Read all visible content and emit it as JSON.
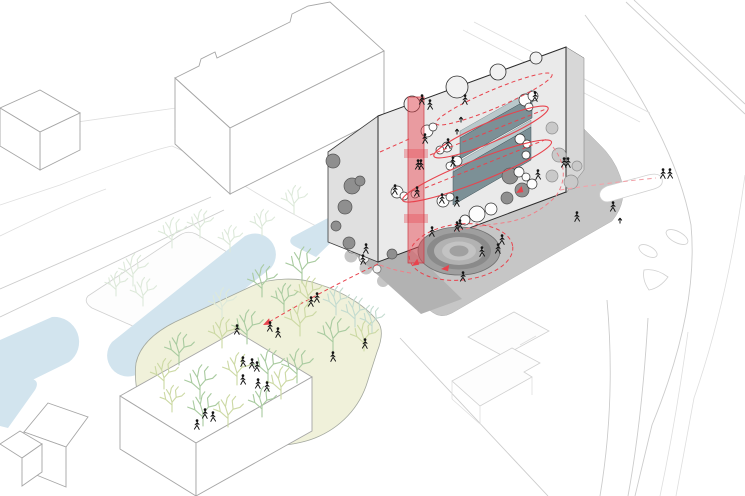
{
  "meta": {
    "type": "architectural-axonometric-circulation-diagram",
    "visible_text": "none"
  },
  "palette": {
    "water": "#d2e4ee",
    "parkFill": "#f0f1da",
    "parkStroke": "#a3a89e",
    "plaza": "#c6c6c6",
    "apron": "#b2b2b2",
    "roof": "#e2e2e2",
    "sideWall": "#d7d7d7",
    "westWall": "#e0e0e0",
    "face": "#eaeaea",
    "outline": "#2b2b2b",
    "slab": "#7c9096",
    "slabTop": "#b9c8cb",
    "slabEdge": "#3f5258",
    "red": "#e8434d",
    "redMid": "#ef8089",
    "redLight": "#f2a3aa",
    "shaftFill": "rgba(233,70,80,0.48)",
    "shaftBand": "rgba(233,70,80,0.36)",
    "shaftStroke": "#c93842",
    "figure": "#141414",
    "road": "#cccccc",
    "roadFaint": "#dedede",
    "contextStroke": "#a6a6a6",
    "faintStroke": "#d0d0d0",
    "cloudWhite": "#fdfdfd",
    "cloudWhiteStroke": "#2e2e2e",
    "cloudDark": "#8f8f8f",
    "cloudDarkStroke": "#565656",
    "cloudExt": "#c9c9c9",
    "cloudExtStroke": "#8f8f8f",
    "biteFill": "#f1f1f1",
    "treeGreen": "#a9cba0",
    "treeYellow": "#ccd9a4",
    "treeBlue": "#c3dbcf",
    "treeFaint": "#dde9da"
  },
  "amphitheater": {
    "cx": 459,
    "cy": 251,
    "rings": [
      {
        "rx": 41,
        "ry": 24,
        "fill": "#9f9f9f",
        "stroke": "#6f6f6f"
      },
      {
        "rx": 32,
        "ry": 18.5,
        "fill": "#8a8a8a",
        "stroke": "none"
      },
      {
        "rx": 25,
        "ry": 14,
        "fill": "#b2b2b2",
        "stroke": "none"
      },
      {
        "rx": 17,
        "ry": 9.5,
        "fill": "#c3c3c3",
        "stroke": "none"
      },
      {
        "rx": 9.5,
        "ry": 5.5,
        "fill": "#a0a0a0",
        "stroke": "none"
      }
    ]
  },
  "bites": [
    {
      "x": 412,
      "y": 104,
      "r": 8
    },
    {
      "x": 457,
      "y": 87,
      "r": 11
    },
    {
      "x": 498,
      "y": 72,
      "r": 8
    },
    {
      "x": 536,
      "y": 58,
      "r": 6
    }
  ],
  "clouds": {
    "white": [
      [
        427,
        131,
        6
      ],
      [
        433,
        127,
        4
      ],
      [
        447,
        147,
        5
      ],
      [
        440,
        150,
        4
      ],
      [
        457,
        161,
        5
      ],
      [
        450,
        166,
        4
      ],
      [
        397,
        192,
        6
      ],
      [
        404,
        196,
        4
      ],
      [
        415,
        194,
        4
      ],
      [
        443,
        201,
        6
      ],
      [
        450,
        197,
        4
      ],
      [
        525,
        100,
        6
      ],
      [
        533,
        96,
        5
      ],
      [
        529,
        107,
        4
      ],
      [
        520,
        139,
        5
      ],
      [
        527,
        144,
        4
      ],
      [
        526,
        155,
        4
      ],
      [
        519,
        172,
        5
      ],
      [
        526,
        177,
        4
      ],
      [
        532,
        184,
        5
      ],
      [
        477,
        214,
        8
      ],
      [
        491,
        209,
        6
      ],
      [
        465,
        220,
        5
      ]
    ],
    "dark": [
      [
        333,
        161,
        7
      ],
      [
        352,
        186,
        8
      ],
      [
        360,
        181,
        5
      ],
      [
        345,
        207,
        7
      ],
      [
        336,
        226,
        5
      ],
      [
        349,
        243,
        6
      ],
      [
        510,
        176,
        8
      ],
      [
        522,
        190,
        7
      ],
      [
        507,
        198,
        6
      ],
      [
        392,
        254,
        5
      ]
    ],
    "exterior": [
      [
        552,
        128,
        6
      ],
      [
        559,
        155,
        7
      ],
      [
        552,
        176,
        6
      ],
      [
        571,
        182,
        7
      ],
      [
        577,
        166,
        5
      ]
    ],
    "apron_bites": [
      [
        352,
        248,
        5
      ],
      [
        364,
        258,
        5
      ],
      [
        377,
        269,
        4
      ]
    ]
  },
  "trees": {
    "park": [
      {
        "x": 302,
        "y": 283,
        "c": "g",
        "s": 1.9
      },
      {
        "x": 262,
        "y": 297,
        "c": "g",
        "s": 1.7
      },
      {
        "x": 222,
        "y": 318,
        "c": "f",
        "s": 1.6
      },
      {
        "x": 247,
        "y": 344,
        "c": "g",
        "s": 1.8
      },
      {
        "x": 222,
        "y": 348,
        "c": "y",
        "s": 1.6
      },
      {
        "x": 179,
        "y": 365,
        "c": "g",
        "s": 1.7
      },
      {
        "x": 164,
        "y": 389,
        "c": "y",
        "s": 1.6
      },
      {
        "x": 200,
        "y": 399,
        "c": "g",
        "s": 1.8
      },
      {
        "x": 237,
        "y": 385,
        "c": "y",
        "s": 1.7
      },
      {
        "x": 268,
        "y": 383,
        "c": "g",
        "s": 1.8
      },
      {
        "x": 300,
        "y": 336,
        "c": "y",
        "s": 1.8
      },
      {
        "x": 333,
        "y": 351,
        "c": "g",
        "s": 1.8
      },
      {
        "x": 364,
        "y": 351,
        "c": "y",
        "s": 1.6
      },
      {
        "x": 297,
        "y": 383,
        "c": "g",
        "s": 1.8
      },
      {
        "x": 281,
        "y": 399,
        "c": "y",
        "s": 1.7
      },
      {
        "x": 203,
        "y": 426,
        "c": "g",
        "s": 1.8
      },
      {
        "x": 228,
        "y": 427,
        "c": "y",
        "s": 1.7
      },
      {
        "x": 262,
        "y": 417,
        "c": "g",
        "s": 1.6
      },
      {
        "x": 172,
        "y": 412,
        "c": "y",
        "s": 1.4
      },
      {
        "x": 355,
        "y": 327,
        "c": "b",
        "s": 1.6
      },
      {
        "x": 372,
        "y": 333,
        "c": "b",
        "s": 1.4
      },
      {
        "x": 336,
        "y": 315,
        "c": "b",
        "s": 1.5
      },
      {
        "x": 308,
        "y": 307,
        "c": "y",
        "s": 1.6
      },
      {
        "x": 284,
        "y": 312,
        "c": "g",
        "s": 1.5
      }
    ],
    "faint": [
      {
        "x": 133,
        "y": 286,
        "c": "f",
        "s": 1.7
      },
      {
        "x": 143,
        "y": 306,
        "c": "f",
        "s": 1.5
      },
      {
        "x": 116,
        "y": 296,
        "c": "f",
        "s": 1.3
      },
      {
        "x": 172,
        "y": 248,
        "c": "f",
        "s": 1.6
      },
      {
        "x": 200,
        "y": 238,
        "c": "f",
        "s": 1.5
      },
      {
        "x": 230,
        "y": 252,
        "c": "f",
        "s": 1.4
      },
      {
        "x": 262,
        "y": 236,
        "c": "f",
        "s": 1.4
      },
      {
        "x": 294,
        "y": 214,
        "c": "f",
        "s": 1.5
      }
    ]
  },
  "figures": {
    "people": [
      [
        422,
        103
      ],
      [
        430,
        108
      ],
      [
        465,
        103
      ],
      [
        535,
        100
      ],
      [
        425,
        142
      ],
      [
        448,
        147
      ],
      [
        418,
        168
      ],
      [
        421,
        168
      ],
      [
        395,
        193
      ],
      [
        417,
        195
      ],
      [
        453,
        165
      ],
      [
        442,
        202
      ],
      [
        457,
        205
      ],
      [
        538,
        178
      ],
      [
        564,
        166
      ],
      [
        568,
        166
      ],
      [
        577,
        220
      ],
      [
        502,
        243
      ],
      [
        498,
        252
      ],
      [
        482,
        255
      ],
      [
        463,
        280
      ],
      [
        457,
        230
      ],
      [
        460,
        228
      ],
      [
        432,
        235
      ],
      [
        366,
        252
      ],
      [
        363,
        263
      ],
      [
        613,
        210
      ],
      [
        663,
        177
      ],
      [
        670,
        177
      ],
      [
        237,
        333
      ],
      [
        270,
        330
      ],
      [
        278,
        336
      ],
      [
        311,
        305
      ],
      [
        317,
        301
      ],
      [
        243,
        365
      ],
      [
        252,
        367
      ],
      [
        257,
        370
      ],
      [
        243,
        383
      ],
      [
        258,
        387
      ],
      [
        267,
        390
      ],
      [
        333,
        360
      ],
      [
        365,
        347
      ],
      [
        205,
        417
      ],
      [
        213,
        420
      ],
      [
        197,
        428
      ]
    ],
    "arrows_up": [
      [
        461,
        117
      ],
      [
        457,
        129
      ],
      [
        620,
        218
      ]
    ]
  },
  "red_arrows": [
    {
      "x": 263,
      "y": 325,
      "rot": -27
    },
    {
      "x": 441,
      "y": 269,
      "rot": -6
    },
    {
      "x": 516,
      "y": 193,
      "rot": -31
    },
    {
      "x": 412,
      "y": 266,
      "rot": -34
    }
  ]
}
